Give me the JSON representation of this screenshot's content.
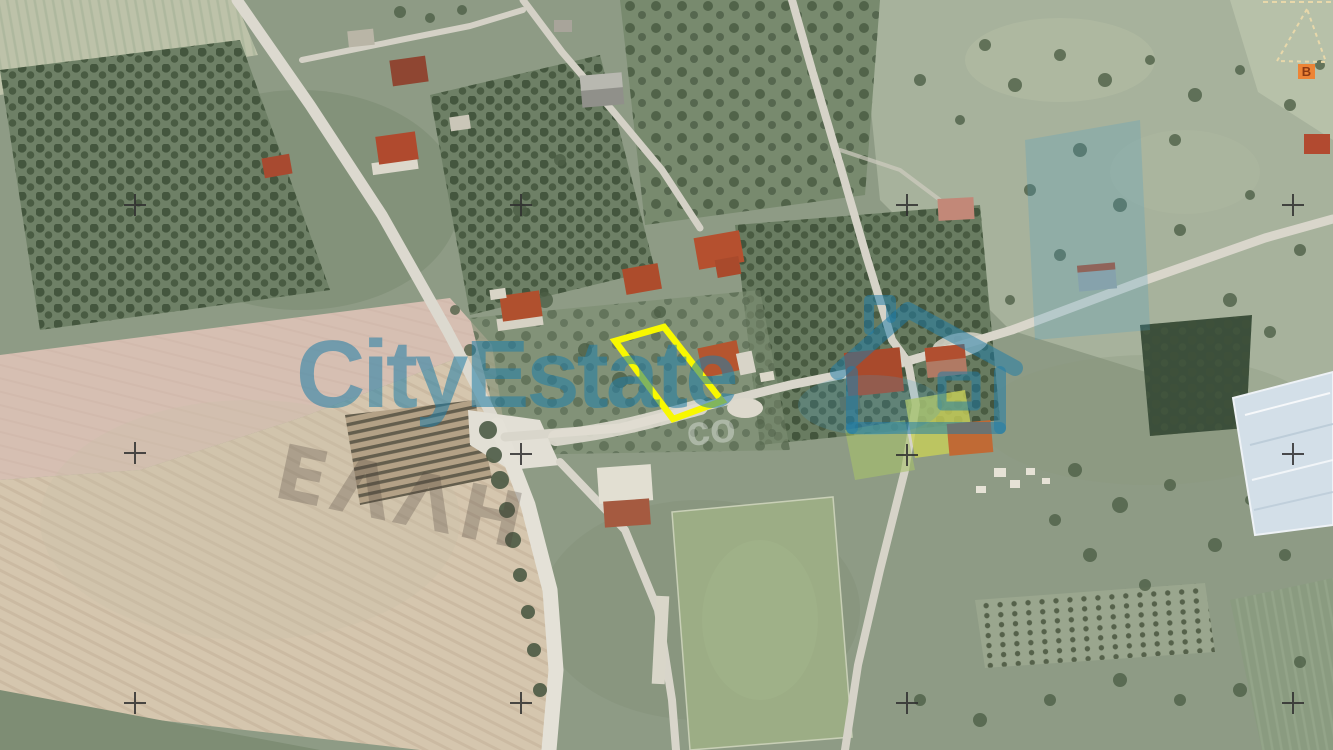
{
  "watermark": {
    "brand": "CityEstate",
    "brand_color": "#1f7da8",
    "ghost_text": "ΕΛΛΗ",
    "ghost_fragment": "co"
  },
  "annotations": {
    "parcel_outline_color": "#f8f800",
    "survey_cross_color": "#2f2f2f",
    "survey_cross_count": 12,
    "triangle_marker": {
      "label": "B",
      "square_color": "#ed8435",
      "label_color": "#8d3a12",
      "outline_color": "#e8d8aa"
    }
  }
}
